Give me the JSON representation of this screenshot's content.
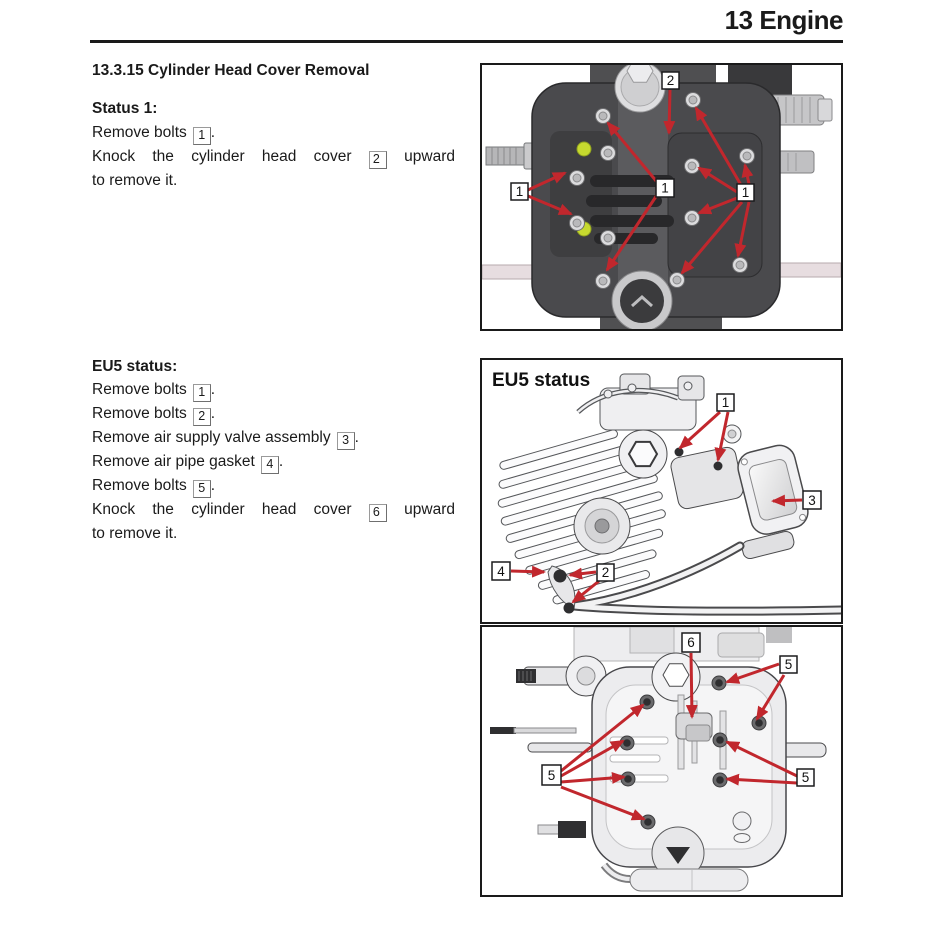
{
  "page": {
    "header_title": "13 Engine"
  },
  "section": {
    "title": "13.3.15 Cylinder Head Cover Removal"
  },
  "status1": {
    "heading": "Status 1:",
    "l1_pre": "Remove bolts",
    "l1_box": "1",
    "l1_post": ".",
    "l2_pre": "Knock the cylinder head cover",
    "l2_box": "2",
    "l2_post": "upward",
    "l3": "to remove it."
  },
  "eu5": {
    "heading": "EU5 status:",
    "l1_pre": "Remove bolts",
    "l1_box": "1",
    "l1_post": ".",
    "l2_pre": "Remove bolts",
    "l2_box": "2",
    "l2_post": ".",
    "l3_pre": "Remove air supply valve assembly",
    "l3_box": "3",
    "l3_post": ".",
    "l4_pre": "Remove air pipe gasket",
    "l4_box": "4",
    "l4_post": ".",
    "l5_pre": "Remove bolts",
    "l5_box": "5",
    "l5_post": ".",
    "l6_pre": "Knock the cylinder head cover",
    "l6_box": "6",
    "l6_post": "upward",
    "l7": "to remove it."
  },
  "figures": {
    "fig1": {
      "callouts": {
        "c2": "2",
        "c1_left": "1",
        "c1_center": "1",
        "c1_right": "1"
      }
    },
    "fig2": {
      "label": "EU5 status",
      "callouts": {
        "c1": "1",
        "c2": "2",
        "c3": "3",
        "c4": "4"
      }
    },
    "fig3": {
      "callouts": {
        "c6": "6",
        "c5_topright": "5",
        "c5_left": "5",
        "c5_right": "5"
      }
    }
  },
  "colors": {
    "arrow_red": "#c1272d",
    "highlight_yellow": "#c6d92f",
    "rule_black": "#1a1a1a"
  }
}
